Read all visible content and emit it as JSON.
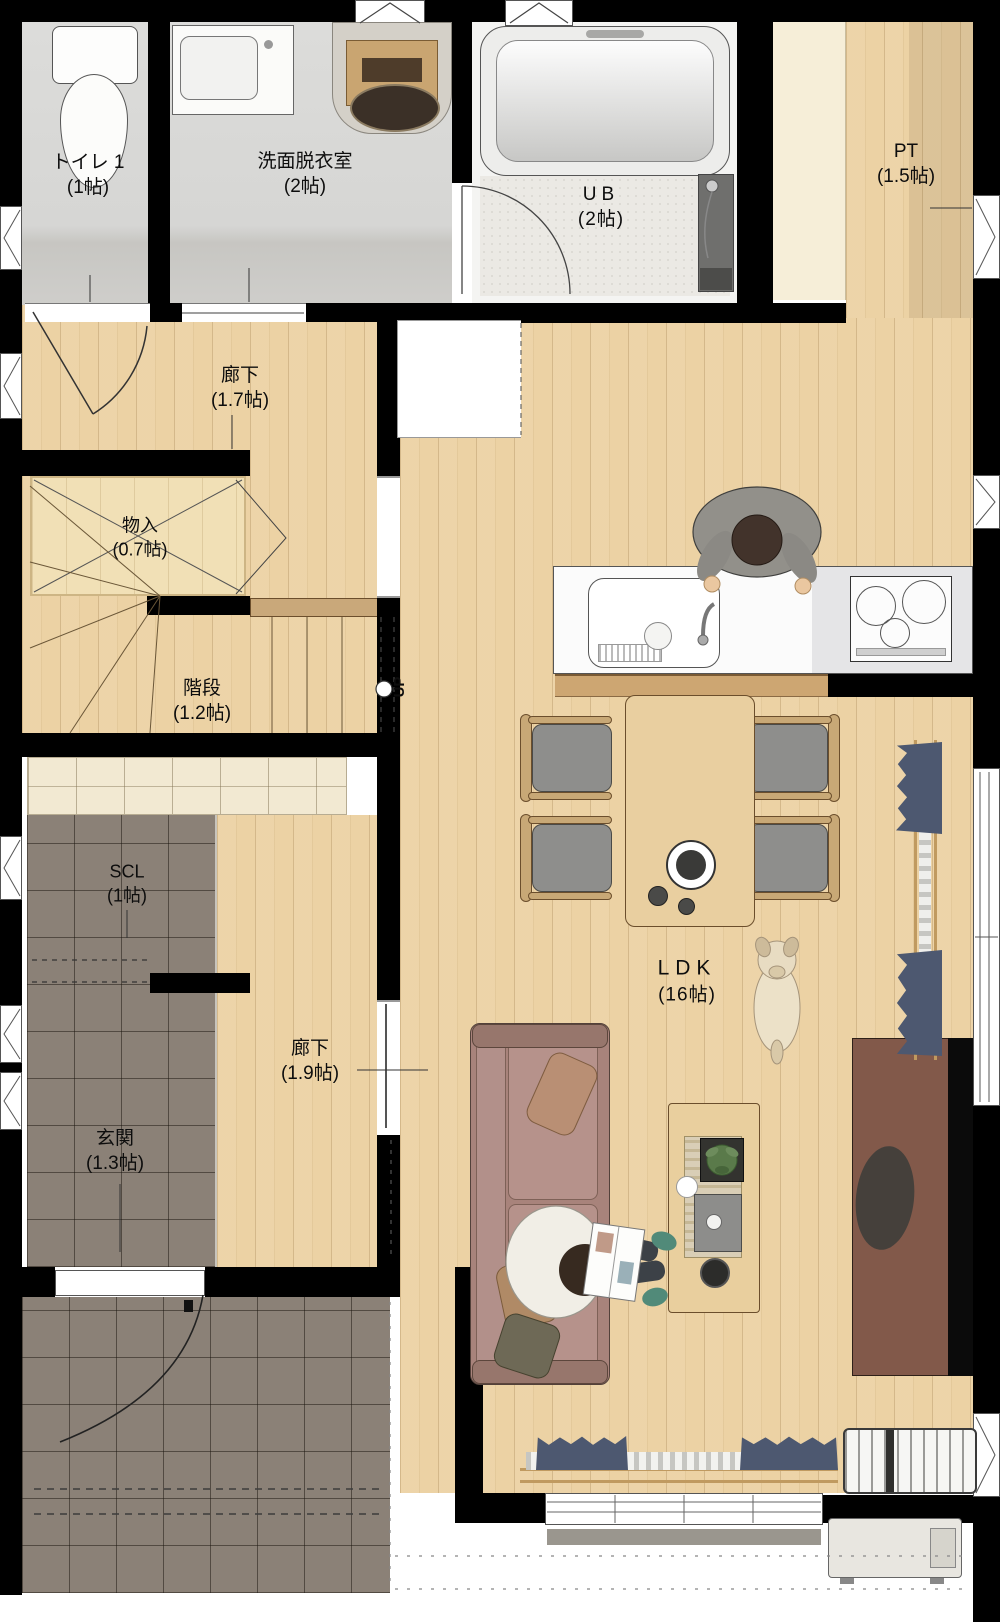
{
  "floorplan": {
    "rooms": {
      "toilet": {
        "name": "トイレ 1",
        "area": "(1帖)"
      },
      "washroom": {
        "name": "洗面脱衣室",
        "area": "(2帖)"
      },
      "unit_bath": {
        "name": "UB",
        "area": "(2帖)"
      },
      "pantry": {
        "name": "PT",
        "area": "(1.5帖)"
      },
      "hallway_upper": {
        "name": "廊下",
        "area": "(1.7帖)"
      },
      "closet": {
        "name": "物入",
        "area": "(0.7帖)"
      },
      "stairs": {
        "name": "階段",
        "area": "(1.2帖)",
        "direction_label": "UP"
      },
      "shoe_closet": {
        "name": "SCL",
        "area": "(1帖)"
      },
      "hallway_lower": {
        "name": "廊下",
        "area": "(1.9帖)"
      },
      "entrance": {
        "name": "玄関",
        "area": "(1.3帖)"
      },
      "ldk": {
        "name": "LDK",
        "area": "(16帖)"
      }
    },
    "colors": {
      "wall": "#000000",
      "wood_floor": "#ecd2a4",
      "dark_tile": "#8b8177",
      "stone_floor": "#d8d8d6",
      "shelf_cream": "#f2e9d2",
      "sofa": "#a8837b",
      "curtain_navy": "#4d5870",
      "tv_board": "#82594a",
      "counter_white": "#fbfbfb"
    }
  }
}
